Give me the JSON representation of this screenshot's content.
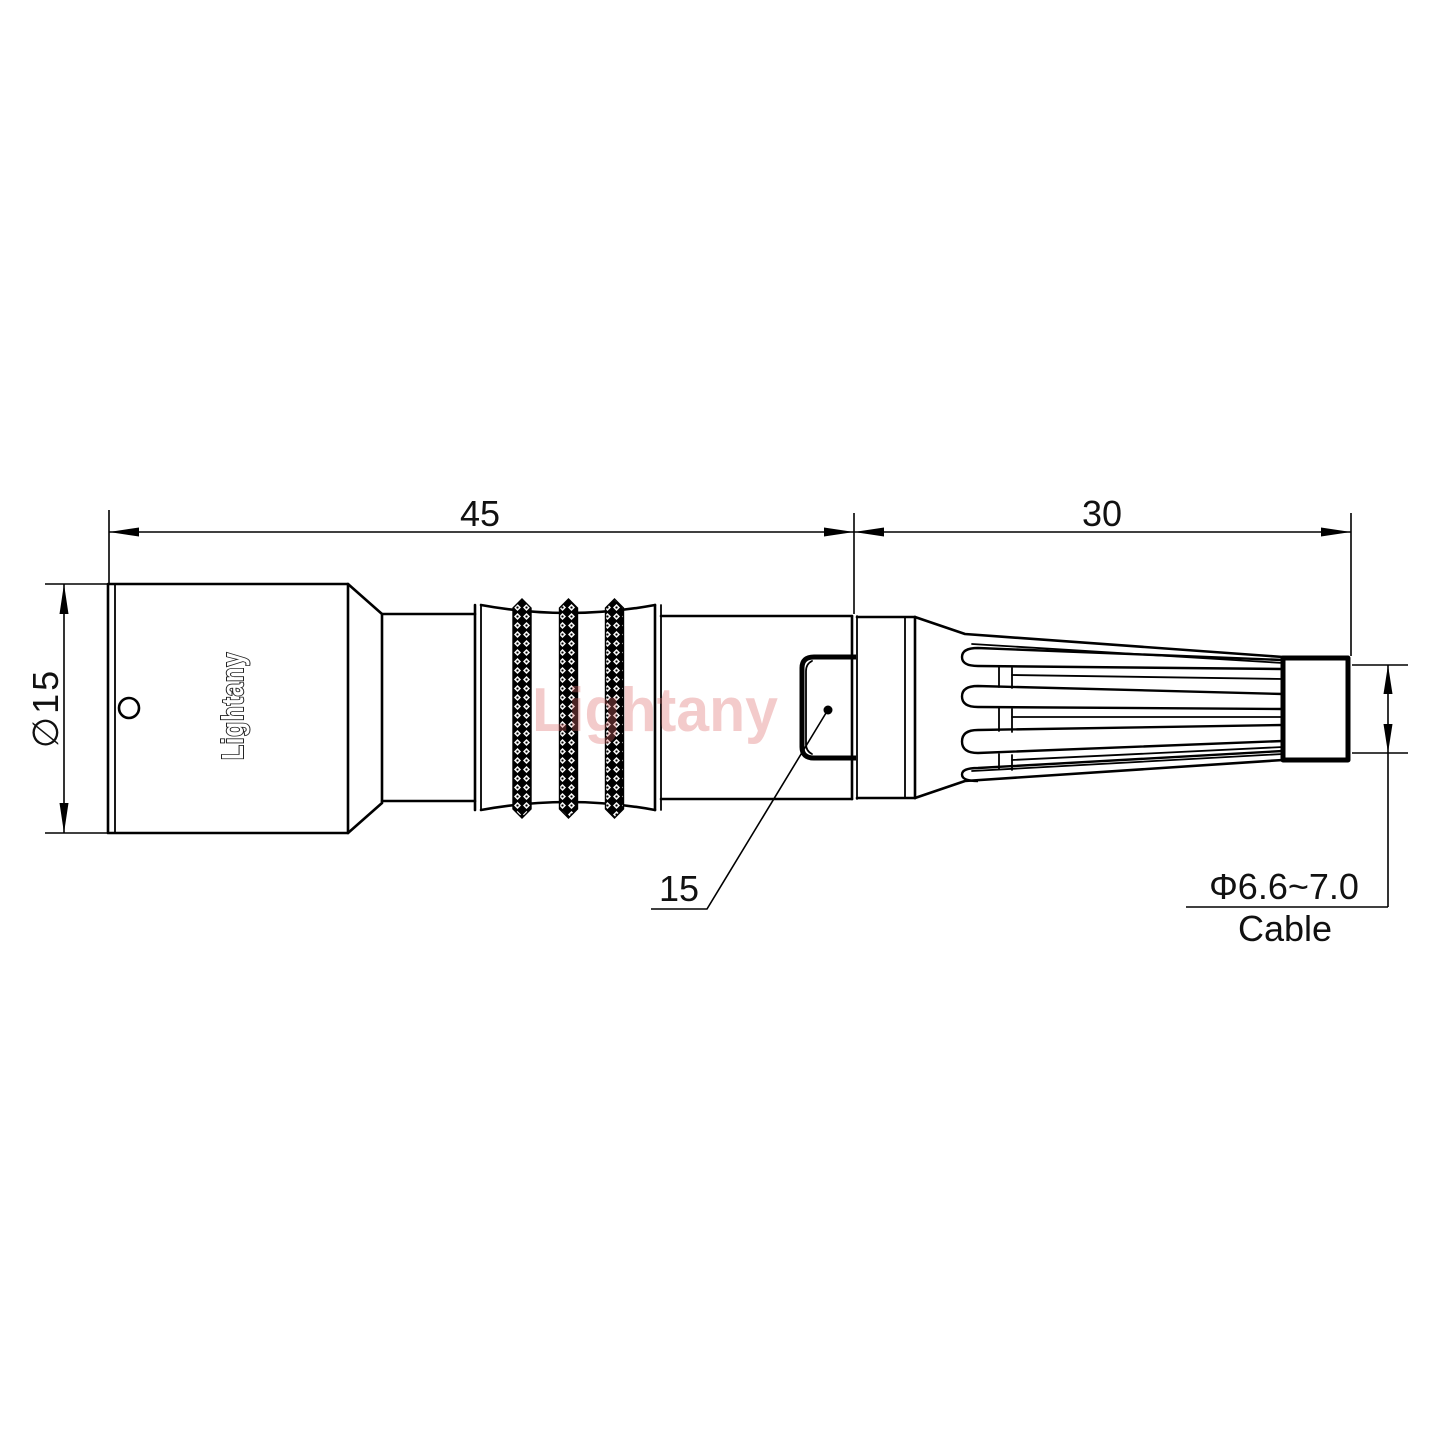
{
  "drawing": {
    "dimensions": {
      "overall_length": "45",
      "boot_length": "30",
      "body_diameter": "∅15",
      "nut_size": "15",
      "cable_diameter": "Φ6.6~7.0",
      "cable_label": "Cable"
    },
    "branding": {
      "body_label": "Lightany",
      "watermark": "Lightany"
    },
    "colors": {
      "line": "#000000",
      "watermark": "#dd6a6a",
      "background": "#ffffff"
    }
  }
}
